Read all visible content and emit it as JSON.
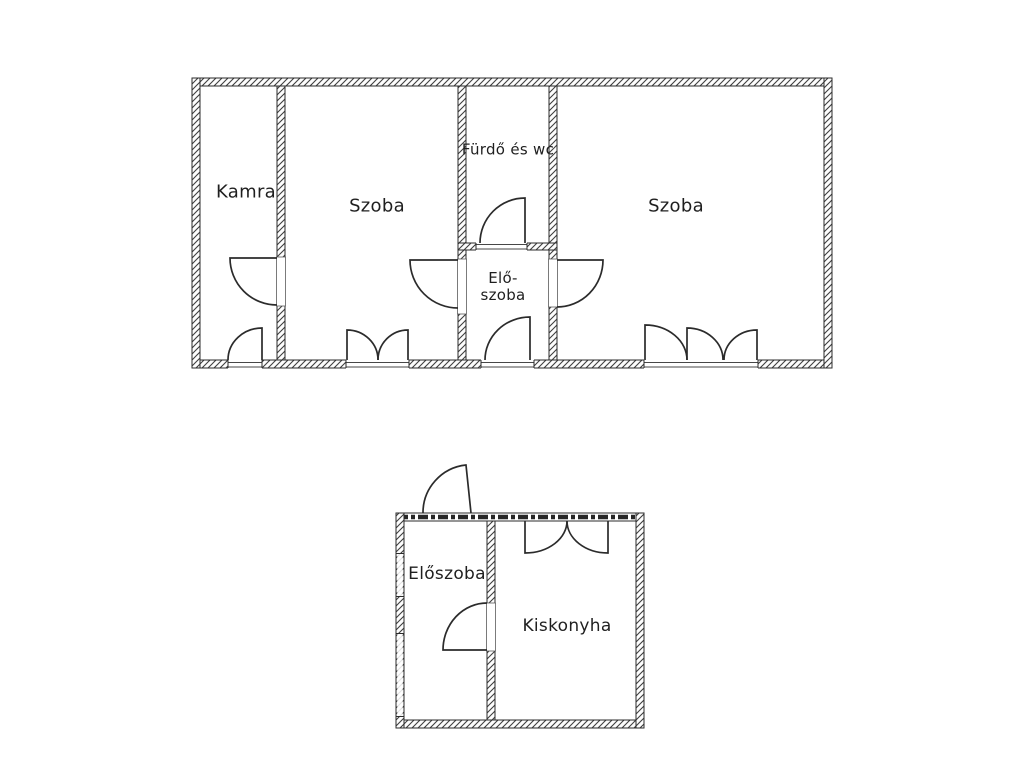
{
  "page": {
    "background_color": "#ffffff",
    "line_color": "#2b2b2b",
    "text_color": "#1f1f1f"
  },
  "floor_plan": {
    "type": "architectural-floor-plan",
    "language": "Hungarian",
    "buildings": [
      {
        "name": "main-building",
        "rooms": [
          {
            "id": "kamra",
            "label": "Kamra"
          },
          {
            "id": "szoba-left",
            "label": "Szoba"
          },
          {
            "id": "furdo-es-wc",
            "label": "Fürdő és wc"
          },
          {
            "id": "eloszoba-upper",
            "label_line1": "Elő-",
            "label_line2": "szoba"
          },
          {
            "id": "szoba-right",
            "label": "Szoba"
          }
        ]
      },
      {
        "name": "annex-building",
        "rooms": [
          {
            "id": "eloszoba-lower",
            "label": "Előszoba"
          },
          {
            "id": "kiskonyha",
            "label": "Kiskonyha"
          }
        ]
      }
    ]
  }
}
